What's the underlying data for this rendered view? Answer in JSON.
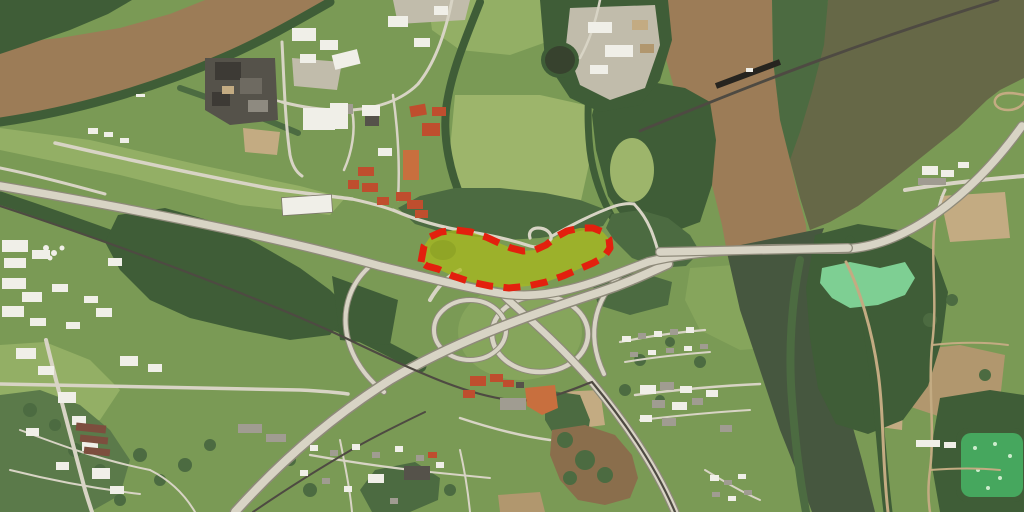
{
  "map": {
    "type": "satellite-aerial-photo",
    "colors": {
      "land": "#7a9a55",
      "field1": "#93af65",
      "field2": "#9db56b",
      "field3": "#86a55c",
      "forest": "#3f5d37",
      "forest2": "#4c6b41",
      "scrub": "#5b7a4a",
      "river_muddy": "#9c7c57",
      "water_olive": "#666847",
      "river_dark": "#46573f",
      "road": "#d8d4c5",
      "road_edge": "#8e8a7a",
      "rail": "#4e4a42",
      "dirt": "#c3ab82",
      "dirt2": "#b1976e",
      "gravel": "#c1bcab",
      "mud": "#8a6e4c",
      "bldg_white": "#f0efe8",
      "bldg_gray": "#a09c91",
      "bldg_dark": "#55524a",
      "roof_red": "#bf4e2e",
      "roof_orange": "#c86f3e",
      "pond_bright": "#7ecf93",
      "pond_treat": "#46a75e",
      "parcel_fill": "#a9ba1c",
      "parcel_stroke": "#e3200e"
    },
    "overlay": {
      "parcel_points": "421,262 424,246 430,237 441,232 456,230 471,232 486,237 499,243 511,248 523,251 535,250 546,245 556,237 567,231 580,228 593,228 603,232 609,239 610,248 604,257 593,263 579,269 563,276 546,282 528,286 509,288 490,286 471,282 453,276 438,269 427,266",
      "stroke_dasharray": "17 10.5",
      "stroke_width": 7,
      "fill_opacity": 0.72
    }
  }
}
